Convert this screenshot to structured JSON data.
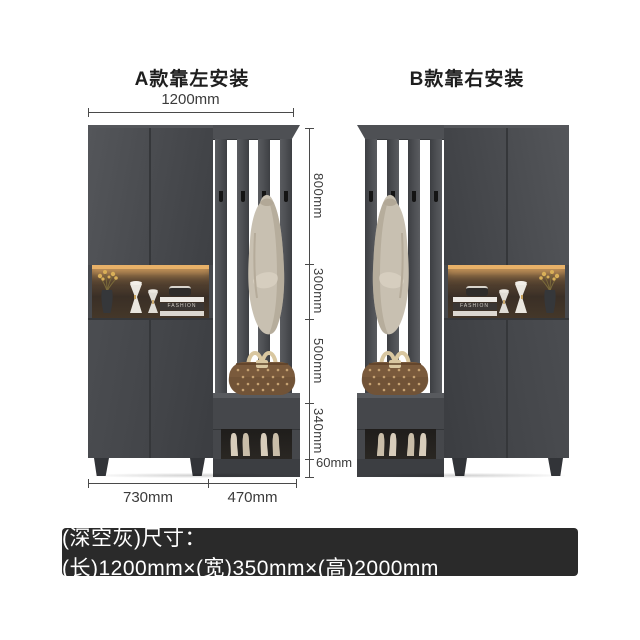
{
  "titles": {
    "model_a": "A款靠左安装",
    "model_b": "B款靠右安装"
  },
  "dimensions": {
    "top_width": "1200mm",
    "height_segments": [
      {
        "label": "800mm"
      },
      {
        "label": "300mm"
      },
      {
        "label": "500mm"
      },
      {
        "label": "340mm"
      },
      {
        "label": "60mm"
      }
    ],
    "bottom_widths": [
      "730mm",
      "470mm"
    ]
  },
  "size_bar": {
    "text": "(深空灰)尺寸：(长)1200mm×(宽)350mm×(高)2000mm"
  },
  "decor": {
    "book_spine": "FASHION"
  },
  "colors": {
    "cabinet": "#47494d",
    "cabinet_dark": "#3b3d41",
    "shelf_glow": "#e8b168",
    "coat": "#c8c0b1",
    "bag_body": "#7a5a3c",
    "bag_pattern": "#c6a272",
    "shoes": "#d8cdbb",
    "dim_line": "#4a4a4a",
    "bar_bg": "#2a2a2a",
    "bar_text": "#ffffff",
    "background": "#ffffff"
  }
}
